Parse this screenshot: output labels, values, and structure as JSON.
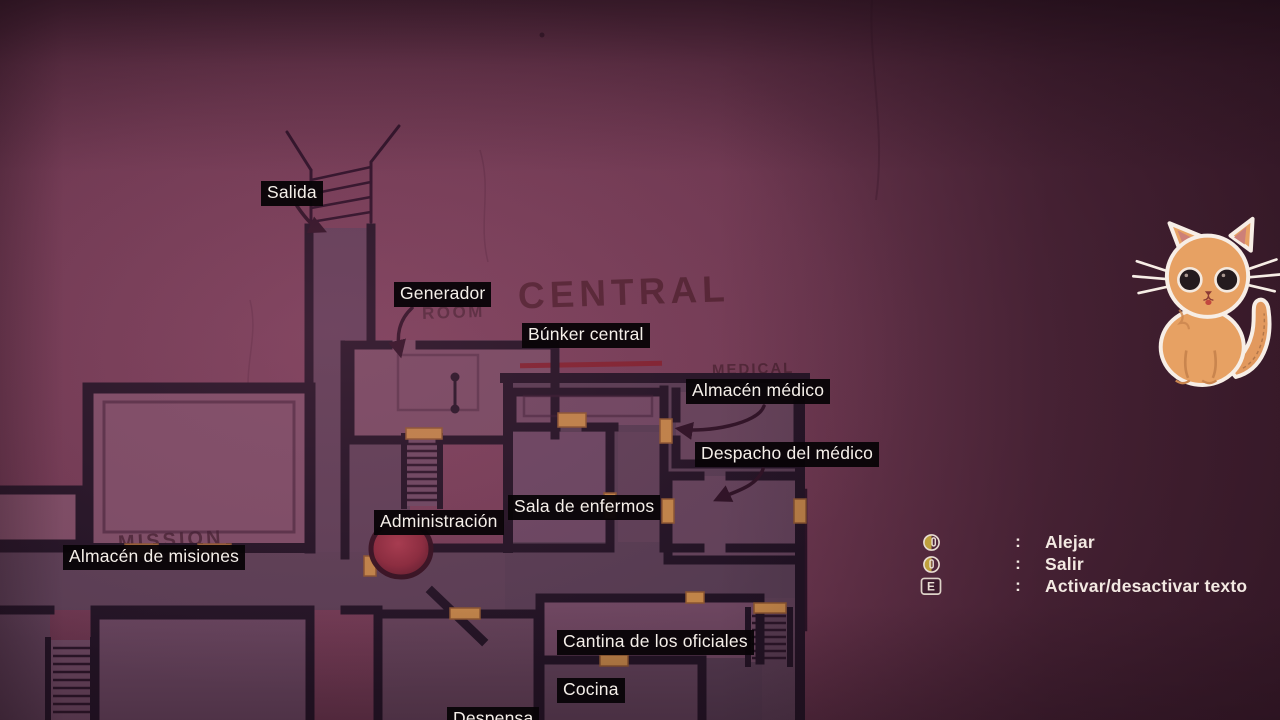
{
  "map": {
    "labels": {
      "salida": "Salida",
      "generador": "Generador",
      "bunker_central": "Búnker central",
      "almacen_medico": "Almacén médico",
      "despacho_del_medico": "Despacho del médico",
      "sala_de_enfermos": "Sala de enfermos",
      "administracion": "Administración",
      "almacen_de_misiones": "Almacén de misiones",
      "cantina_de_los_oficiales": "Cantina de los oficiales",
      "cocina": "Cocina",
      "despensa": "Despensa"
    },
    "painted_text": {
      "central": "CENTRAL",
      "room": "ROOM",
      "medical": "MEDICAL",
      "mission": "MISSION"
    }
  },
  "legend": {
    "rows": [
      {
        "icon": "mouse-scroll-icon",
        "colon": ":",
        "label": "Alejar"
      },
      {
        "icon": "mouse-button-icon",
        "colon": ":",
        "label": "Salir"
      },
      {
        "icon": "key-e-icon",
        "key": "E",
        "colon": ":",
        "label": "Activar/desactivar texto"
      }
    ]
  },
  "colors": {
    "label_bg": "#080407",
    "label_text": "#f5efe9",
    "legend_text": "#f3e9e2",
    "wall": "#211324",
    "door": "#c08448",
    "marker_red": "#962f40",
    "accent_gold": "#bfa03d"
  }
}
